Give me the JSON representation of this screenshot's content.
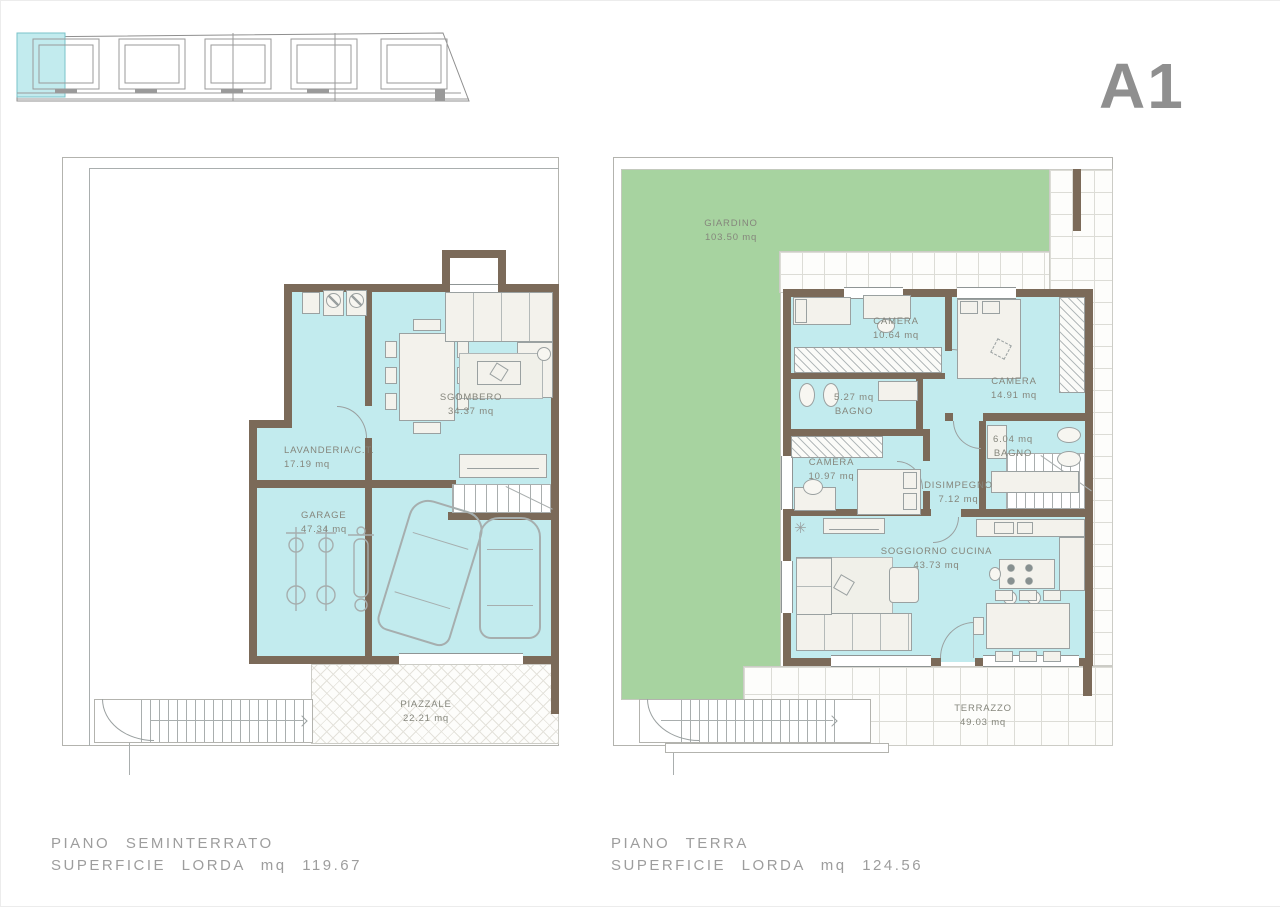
{
  "sheet": {
    "unit_label": "A1"
  },
  "colors": {
    "room_fill": "#c2ebee",
    "garden_fill": "#a7d3a0",
    "wall": "#7b6a59",
    "label_text": "#85867c",
    "caption_text": "#9d9d9d",
    "unit_label_text": "#8f8f8f"
  },
  "site_plan": {
    "units_count": 5,
    "highlighted_unit": "A1"
  },
  "plans": {
    "seminterrato": {
      "caption_title": "PIANO SEMINTERRATO",
      "caption_area": "SUPERFICIE LORDA mq 119.67",
      "rooms": {
        "sgombero": {
          "name": "SGOMBERO",
          "area": "34.37 mq"
        },
        "lavanderia": {
          "name": "LAVANDERIA/C.T.",
          "area": "17.19 mq"
        },
        "garage": {
          "name": "GARAGE",
          "area": "47.34 mq"
        },
        "piazzale": {
          "name": "PIAZZALE",
          "area": "22.21 mq"
        }
      }
    },
    "terra": {
      "caption_title": "PIANO TERRA",
      "caption_area": "SUPERFICIE LORDA mq 124.56",
      "rooms": {
        "giardino": {
          "name": "GIARDINO",
          "area": "103.50 mq"
        },
        "camera1": {
          "name": "CAMERA",
          "area": "10.64 mq"
        },
        "camera2": {
          "name": "CAMERA",
          "area": "14.91 mq"
        },
        "bagno1": {
          "name": "BAGNO",
          "area": "5.27 mq"
        },
        "bagno2": {
          "name": "BAGNO",
          "area": "6.04 mq"
        },
        "camera3": {
          "name": "CAMERA",
          "area": "10.97 mq"
        },
        "disimpegno": {
          "name": "DISIMPEGNO",
          "area": "7.12 mq"
        },
        "soggiorno": {
          "name": "SOGGIORNO CUCINA",
          "area": "43.73 mq"
        },
        "terrazzo": {
          "name": "TERRAZZO",
          "area": "49.03 mq"
        }
      }
    }
  }
}
